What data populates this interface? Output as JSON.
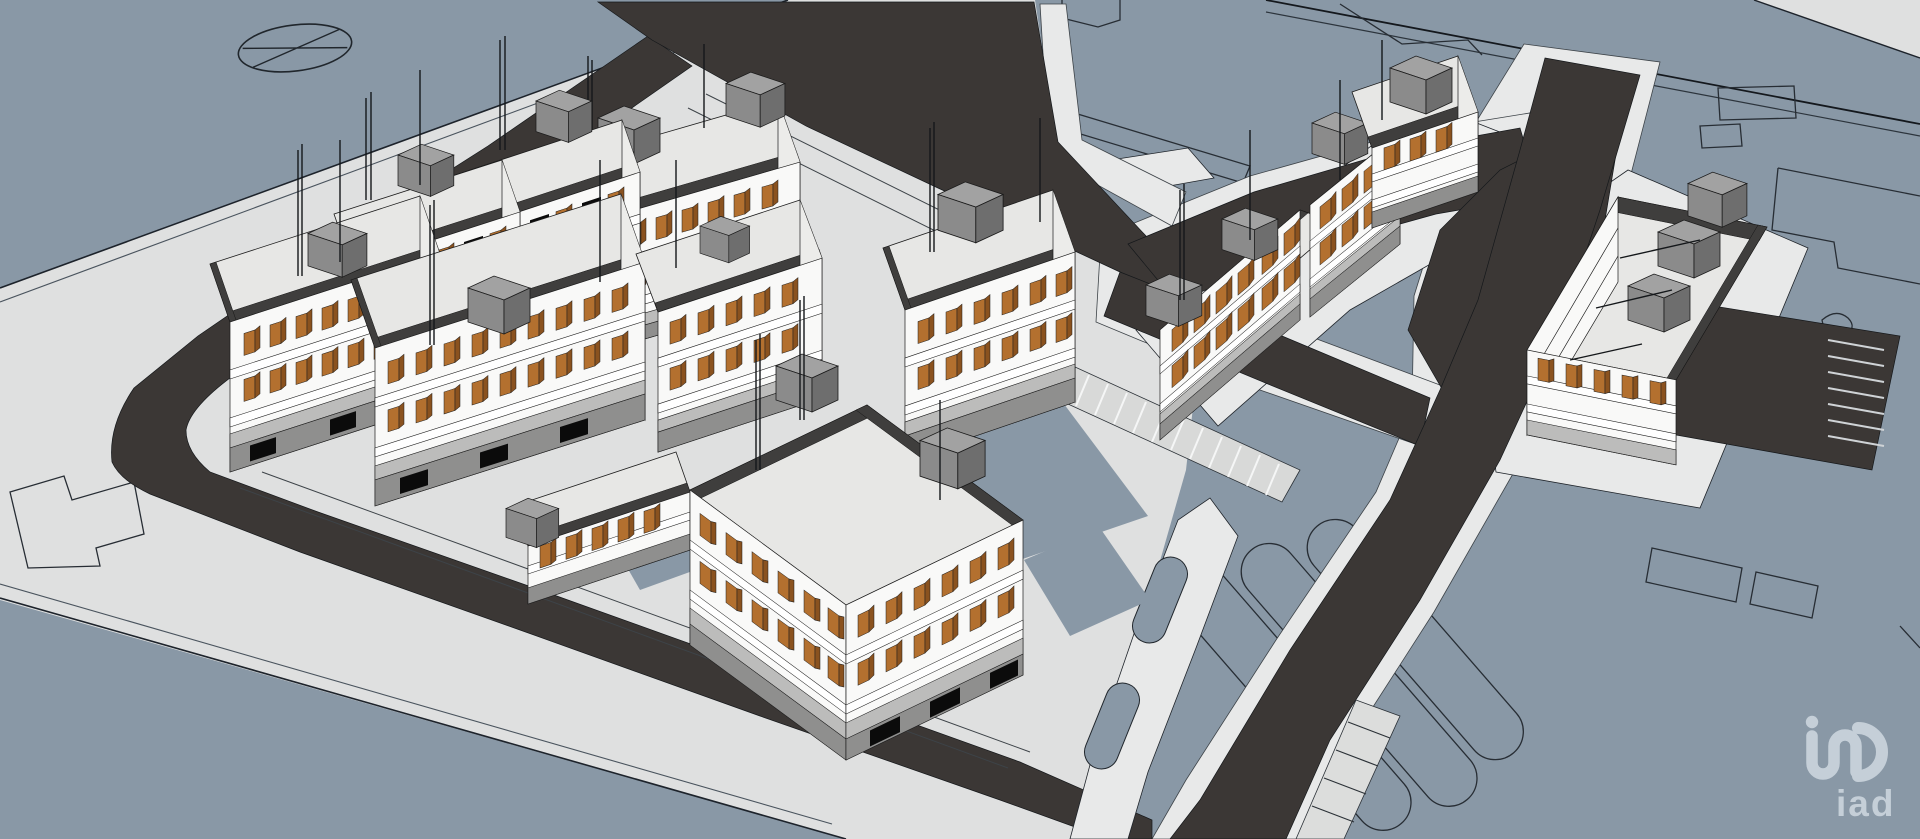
{
  "watermark": {
    "brand": "iad",
    "glyph": "iad-monogram"
  },
  "palette": {
    "terrain_blue": "#8998a6",
    "ground_light": "#dfe0e0",
    "pad_light": "#e8e9e9",
    "road_dark": "#3b3735",
    "roof_light": "#e7e7e5",
    "parapet_dark": "#3f3e3d",
    "building_white": "#f9f9f8",
    "facade_shade": "#ececea",
    "opening_black": "#0b0b0b",
    "shutter_brown": "#b3702f",
    "shutter_brown_dark": "#8a521f",
    "box_gray_top": "#a2a2a2",
    "box_gray_front": "#8b8b8b",
    "box_gray_side": "#6e6e6e",
    "line_dark": "#1f242a",
    "logo_tint": "#c5cfd8"
  },
  "scene": {
    "kind": "3d-architectural-massing-model",
    "view": "aerial-axonometric",
    "apartment_blocks_visible": 13,
    "roundabout_marking": 1,
    "watermark_text": "iad"
  }
}
